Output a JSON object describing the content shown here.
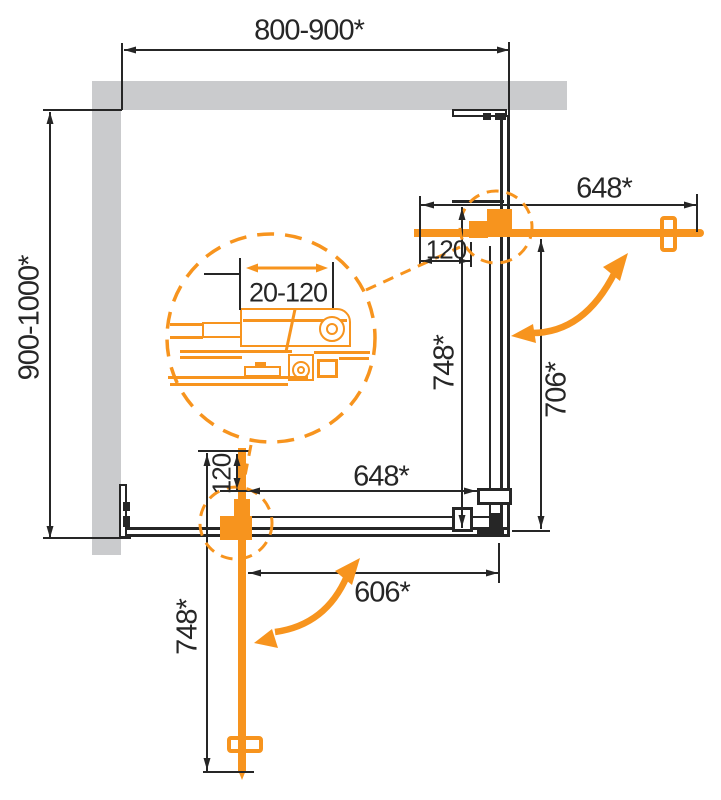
{
  "colors": {
    "accent": "#F7941E",
    "wall": "#CACBCD",
    "line": "#262626"
  },
  "dims": {
    "overall_width": "800-900*",
    "overall_depth": "900-1000*",
    "right_section": {
      "door_length": "648*",
      "pivot_offset": "120",
      "panel_height": "748*",
      "opening_height": "706*"
    },
    "bottom_section": {
      "door_length": "748*",
      "pivot_offset": "120",
      "panel_width": "648*",
      "opening_width": "606*"
    },
    "detail": {
      "adjustment_range": "20-120"
    }
  }
}
